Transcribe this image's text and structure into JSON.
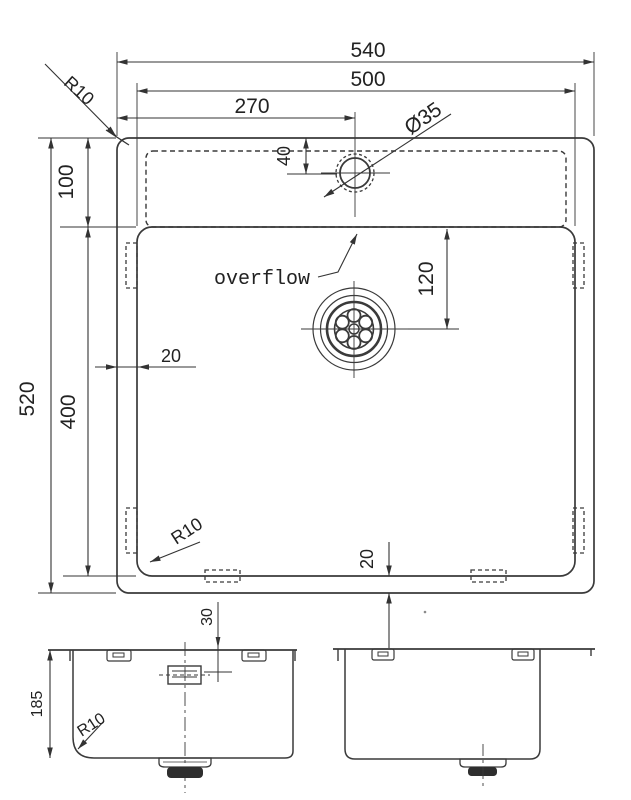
{
  "drawing": {
    "plan": {
      "overall_width": "540",
      "bowl_width": "500",
      "faucet_offset": "270",
      "faucet_diameter": "Ø35",
      "rim_corner_radius": "R10",
      "ledge_depth": "100",
      "overall_length": "520",
      "bowl_length": "400",
      "rim_gap_left": "20",
      "faucet_from_rim": "40",
      "drain_from_overflow": "120",
      "overflow_label": "overflow",
      "rim_gap_bottom": "20",
      "bowl_corner_radius": "R10"
    },
    "front_view": {
      "bowl_depth": "185",
      "bottom_corner_radius": "R10",
      "overflow_drop": "30"
    },
    "colors": {
      "line": "#3a3a3a",
      "dimension": "#333333",
      "text": "#222222",
      "background": "#ffffff"
    }
  }
}
